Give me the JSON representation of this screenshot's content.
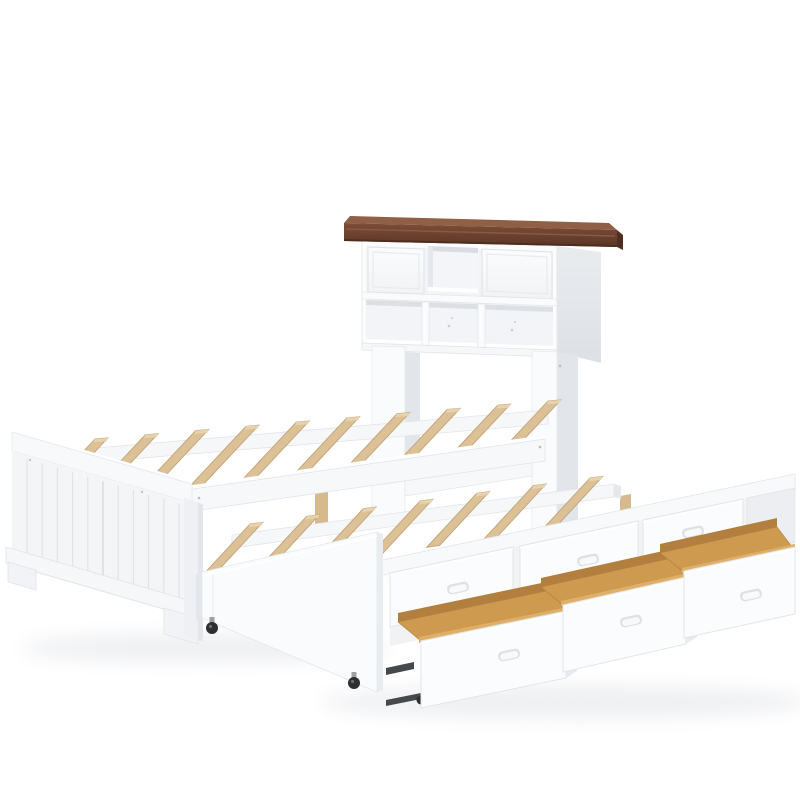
{
  "scene": {
    "type": "product-photo",
    "subject": "White wooden captain's bed with bookcase headboard, natural wood slats, pull-out trundle bed on casters and three open storage drawers, shown on a plain white background",
    "background": "#ffffff"
  },
  "colors": {
    "frame_white": "#fbfcfd",
    "frame_panel": "#f4f5f7",
    "frame_shade": "#eef0f3",
    "frame_side": "#e7eaee",
    "edge_line": "#dfe2e7",
    "shadow_soft": "#eceef0",
    "cubby_back": "#f3f4f7",
    "cubby_shadow": "#d9dce1",
    "crown_top": "#91604646",
    "crown_bevel": "#8f5f46",
    "crown_front": "#6b4231",
    "crown_dark": "#4f2e1f",
    "slat_wood": "#dcc096",
    "slat_wood_edge": "#c2a376",
    "leg_wood": "#d6ba8e",
    "leg_foot": "#3a3a3c",
    "drawer_wood_floor": "#cd9a50",
    "drawer_wood_back": "#b37f3e",
    "drawer_wood_lip": "#e0af67",
    "metal_slide": "#45484c",
    "caster": "#2e2f31",
    "handle_outer": "#dde1e6",
    "handle_inner": "#f7f9fa"
  },
  "headboard": {
    "part": "bookcase headboard",
    "crown": "walnut brown crown molding",
    "top_row": {
      "closed_doors": 2,
      "open_cubbies": 1
    },
    "bottom_row": {
      "open_cubbies": 3
    }
  },
  "main_bed": {
    "part": "platform bed frame",
    "slat_count": 10,
    "footboard_plank_grooves": 11,
    "center_support_legs": 2
  },
  "trundle": {
    "part": "pull-out trundle bed",
    "slat_count": 7,
    "caster_count": 2
  },
  "storage": {
    "part": "under-bed storage drawers",
    "closed_drawer_count": 3,
    "open_drawer_count": 3,
    "interior_finish": "natural wood"
  }
}
